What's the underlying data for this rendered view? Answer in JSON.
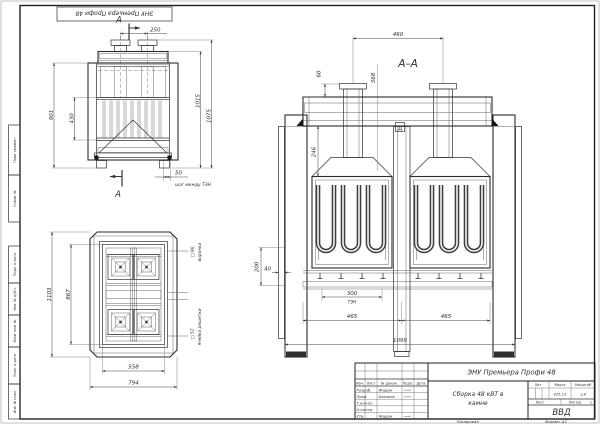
{
  "sheet": {
    "stamp": "ЭНУ Премьера Профи 48",
    "margin_labels": [
      "Перв. примен.",
      "Справ. №",
      "Подп. и дата",
      "Инв. № дубл.",
      "Взам. инв. №",
      "Подп. и дата",
      "Инв. № подл."
    ],
    "footer": {
      "copied": "Копировал",
      "format": "Формат А2"
    }
  },
  "front_view": {
    "section_letter": "А",
    "dims": {
      "pipe_spacing": "250",
      "body_height": "901",
      "inner_height": "430",
      "height_1": "1015",
      "height_2": "1075",
      "step": "50",
      "step_note": "шаг между ТЭН"
    }
  },
  "plan_view": {
    "dims": {
      "outer_length": "1103",
      "inner_length": "867",
      "inner_width": "558",
      "outer_width": "794"
    },
    "callouts": {
      "opening_size": "□ 90",
      "opening_label": "воронка",
      "cell_size": "□ 57",
      "cell_label": "ячейка решетки"
    }
  },
  "section_view": {
    "label": "А–А",
    "datum": "Д",
    "dims": {
      "pipe_spacing": "460",
      "stub": "60",
      "depth": "368",
      "hood": "246",
      "chamber": "200",
      "wall": "40",
      "ten_width": "300",
      "ten": "ТЭН",
      "bay_left": "465",
      "bay_right": "465",
      "total": "1099"
    }
  },
  "title_block": {
    "title": "ЭНУ Премьера Профи 48",
    "doc_lines": [
      "Сборка 48 кВТ в",
      "камне"
    ],
    "org": "ВВД",
    "headers": {
      "lit": "Лит.",
      "mass": "Масса",
      "scale": "Масштаб",
      "sheet": "Лист",
      "sheets": "Листов",
      "sheets_value": "1"
    },
    "values": {
      "mass": "425,11",
      "scale": "1:9"
    },
    "sign_cols": {
      "izm": "Изм.",
      "list": "Лист",
      "doc": "№ докум.",
      "podp": "Подп.",
      "data": "Дата"
    },
    "rows": [
      {
        "role": "Разраб.",
        "name": "Жадан"
      },
      {
        "role": "Пров.",
        "name": "Казаков"
      },
      {
        "role": "Т.контр.",
        "name": ""
      },
      {
        "role": "Н.контр.",
        "name": ""
      },
      {
        "role": "Утв.",
        "name": "Жадан"
      }
    ]
  }
}
